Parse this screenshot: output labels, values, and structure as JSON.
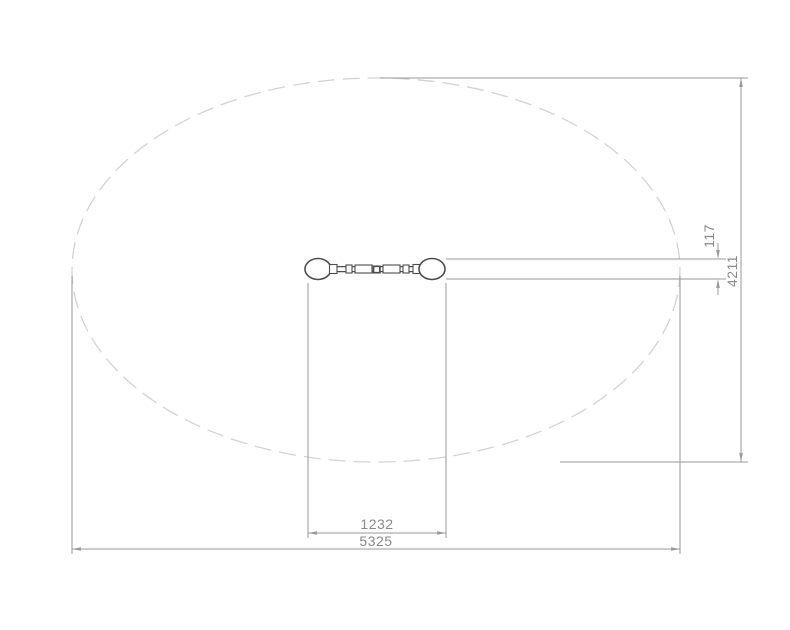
{
  "figure": {
    "type": "technical-drawing-top-view",
    "dimensions": {
      "anchor_width": "117",
      "zone_depth": "4211",
      "element_span": "1232",
      "zone_length": "5325"
    },
    "colors": {
      "outline": "#4d4d4d",
      "dimension_line": "#9a9a9a",
      "dimension_text": "#8a8a8a",
      "safety_zone": "#d3d3d3"
    }
  }
}
